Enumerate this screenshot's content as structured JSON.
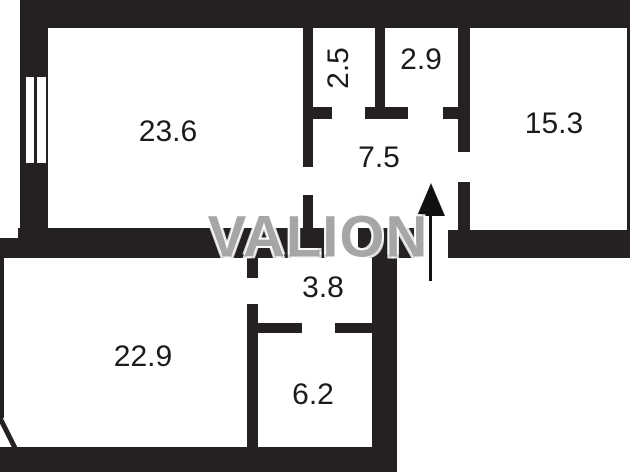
{
  "watermark": {
    "text": "VALION",
    "color": "#9e9e9e"
  },
  "rooms": [
    {
      "area": "23.6",
      "position": "top-left"
    },
    {
      "area": "2.5",
      "position": "top-middle-left",
      "text_rotated": true
    },
    {
      "area": "2.9",
      "position": "top-middle-right"
    },
    {
      "area": "15.3",
      "position": "top-right"
    },
    {
      "area": "7.5",
      "position": "center-hall"
    },
    {
      "area": "3.8",
      "position": "lower-middle"
    },
    {
      "area": "22.9",
      "position": "bottom-left"
    },
    {
      "area": "6.2",
      "position": "bottom-middle"
    }
  ],
  "icons": {
    "entrance_arrow": "up-arrow"
  },
  "colors": {
    "wall": "#252121",
    "background": "#ffffff",
    "label": "#1b1b1b"
  }
}
